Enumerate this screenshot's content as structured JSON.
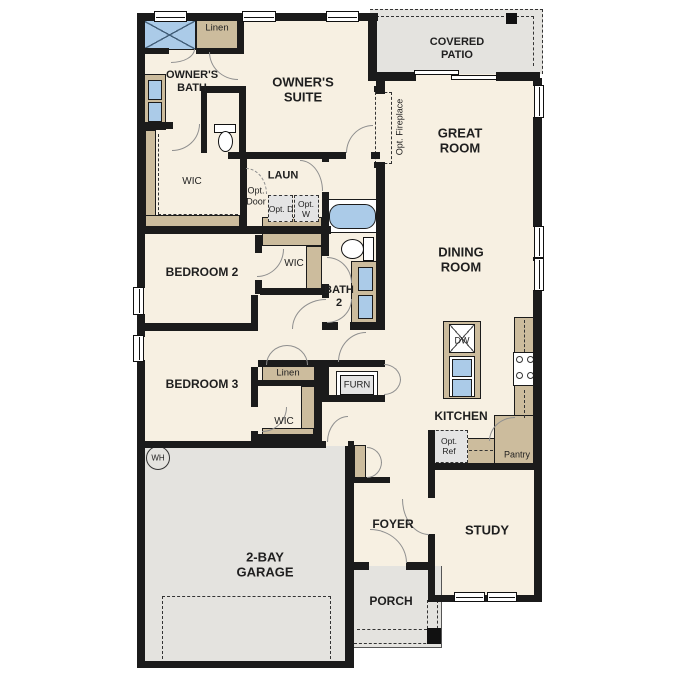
{
  "plan": {
    "title": "single-story floor plan",
    "labels": {
      "owners_bath": "OWNER'S BATH",
      "owners_suite": "OWNER'S SUITE",
      "linen_owner": "Linen",
      "wic_owner": "WIC",
      "laundry": "LAUN",
      "opt_door": "Opt. Door",
      "opt_dryer": "Opt. D",
      "opt_washer": "Opt. W",
      "covered_patio": "COVERED PATIO",
      "great_room": "GREAT ROOM",
      "opt_fireplace": "Opt. Fireplace",
      "dining_room": "DINING ROOM",
      "bedroom2": "BEDROOM 2",
      "wic_bedroom2": "WIC",
      "bath2": "BATH 2",
      "bedroom3": "BEDROOM 3",
      "linen_bedroom3": "Linen",
      "wic_bedroom3": "WIC",
      "furnace": "FURN",
      "kitchen": "KITCHEN",
      "dishwasher": "DW",
      "opt_refrigerator": "Opt. Ref",
      "pantry": "Pantry",
      "water_heater": "WH",
      "garage": "2-BAY GARAGE",
      "foyer": "FOYER",
      "porch": "PORCH",
      "study": "STUDY"
    },
    "colors": {
      "floor": "#f7f0e2",
      "outdoor": "#e4e3df",
      "wall": "#1b1b1b",
      "cabinet": "#ccbc9d",
      "fixture": "#abcbe8",
      "annotation_box": "#e4e4e4",
      "door": "#8f8f8f",
      "text": "#1f1f1f"
    }
  }
}
